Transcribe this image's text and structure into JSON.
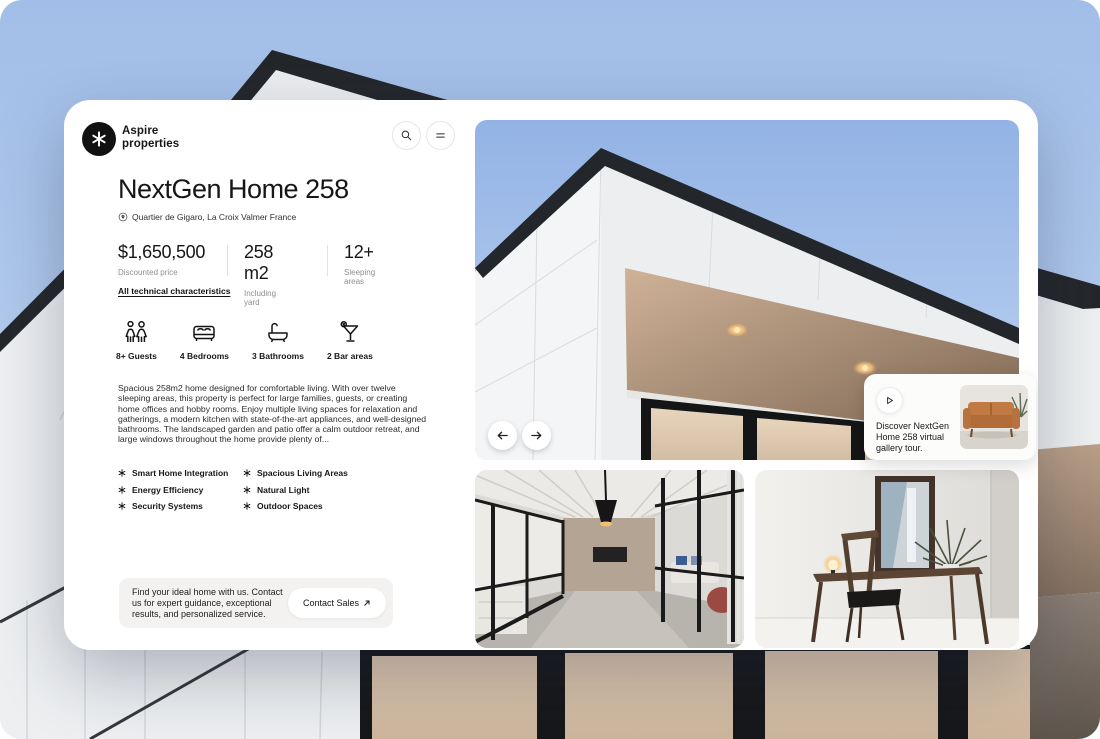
{
  "brand": {
    "line1": "Aspire",
    "line2": "properties"
  },
  "icons": {
    "logo": "asterisk-star",
    "search": "magnifier",
    "menu": "hamburger-menu",
    "location": "map-pin",
    "amenities": [
      "two-guests",
      "double-bed",
      "bathtub",
      "cocktail-glass"
    ],
    "feature_bullet": "asterisk",
    "play": "play-triangle",
    "prev": "arrow-left",
    "next": "arrow-right",
    "contact_arrow": "arrow-up-right"
  },
  "property": {
    "title": "NextGen Home 258",
    "location": "Quartier de Gigaro, La Croix Valmer France",
    "stats": [
      {
        "value": "$1,650,500",
        "label": "Discounted price"
      },
      {
        "value": "258 m2",
        "label": "Including yard"
      },
      {
        "value": "12+",
        "label": "Sleeping areas"
      }
    ],
    "tech_link": "All technical characteristics",
    "amenities": [
      {
        "label": "8+ Guests"
      },
      {
        "label": "4 Bedrooms"
      },
      {
        "label": "3 Bathrooms"
      },
      {
        "label": "2 Bar areas"
      }
    ],
    "description": "Spacious 258m2 home designed for comfortable living. With over twelve sleeping areas, this property is perfect for large families, guests, or creating home offices and hobby rooms. Enjoy multiple living spaces for relaxation and gatherings, a modern kitchen with state-of-the-art appliances, and well-designed bathrooms. The landscaped garden and patio offer a calm outdoor retreat, and large windows throughout the home provide plenty of...",
    "features_col1": [
      "Smart Home Integration",
      "Energy Efficiency",
      "Security Systems"
    ],
    "features_col2": [
      "Spacious Living Areas",
      "Natural Light",
      "Outdoor Spaces"
    ]
  },
  "contact": {
    "message": "Find your ideal home with us. Contact us for expert guidance, exceptional results, and personalized service.",
    "button_label": "Contact Sales"
  },
  "tour": {
    "caption": "Discover NextGen Home 258 virtual gallery tour."
  },
  "colors": {
    "sky": "#a9c3ea",
    "card": "#ffffff",
    "text": "#161616",
    "muted": "#8f8f8f",
    "contact_box": "#f3f2f0",
    "roof": "#24272a",
    "glass": "#dcc6ad"
  }
}
